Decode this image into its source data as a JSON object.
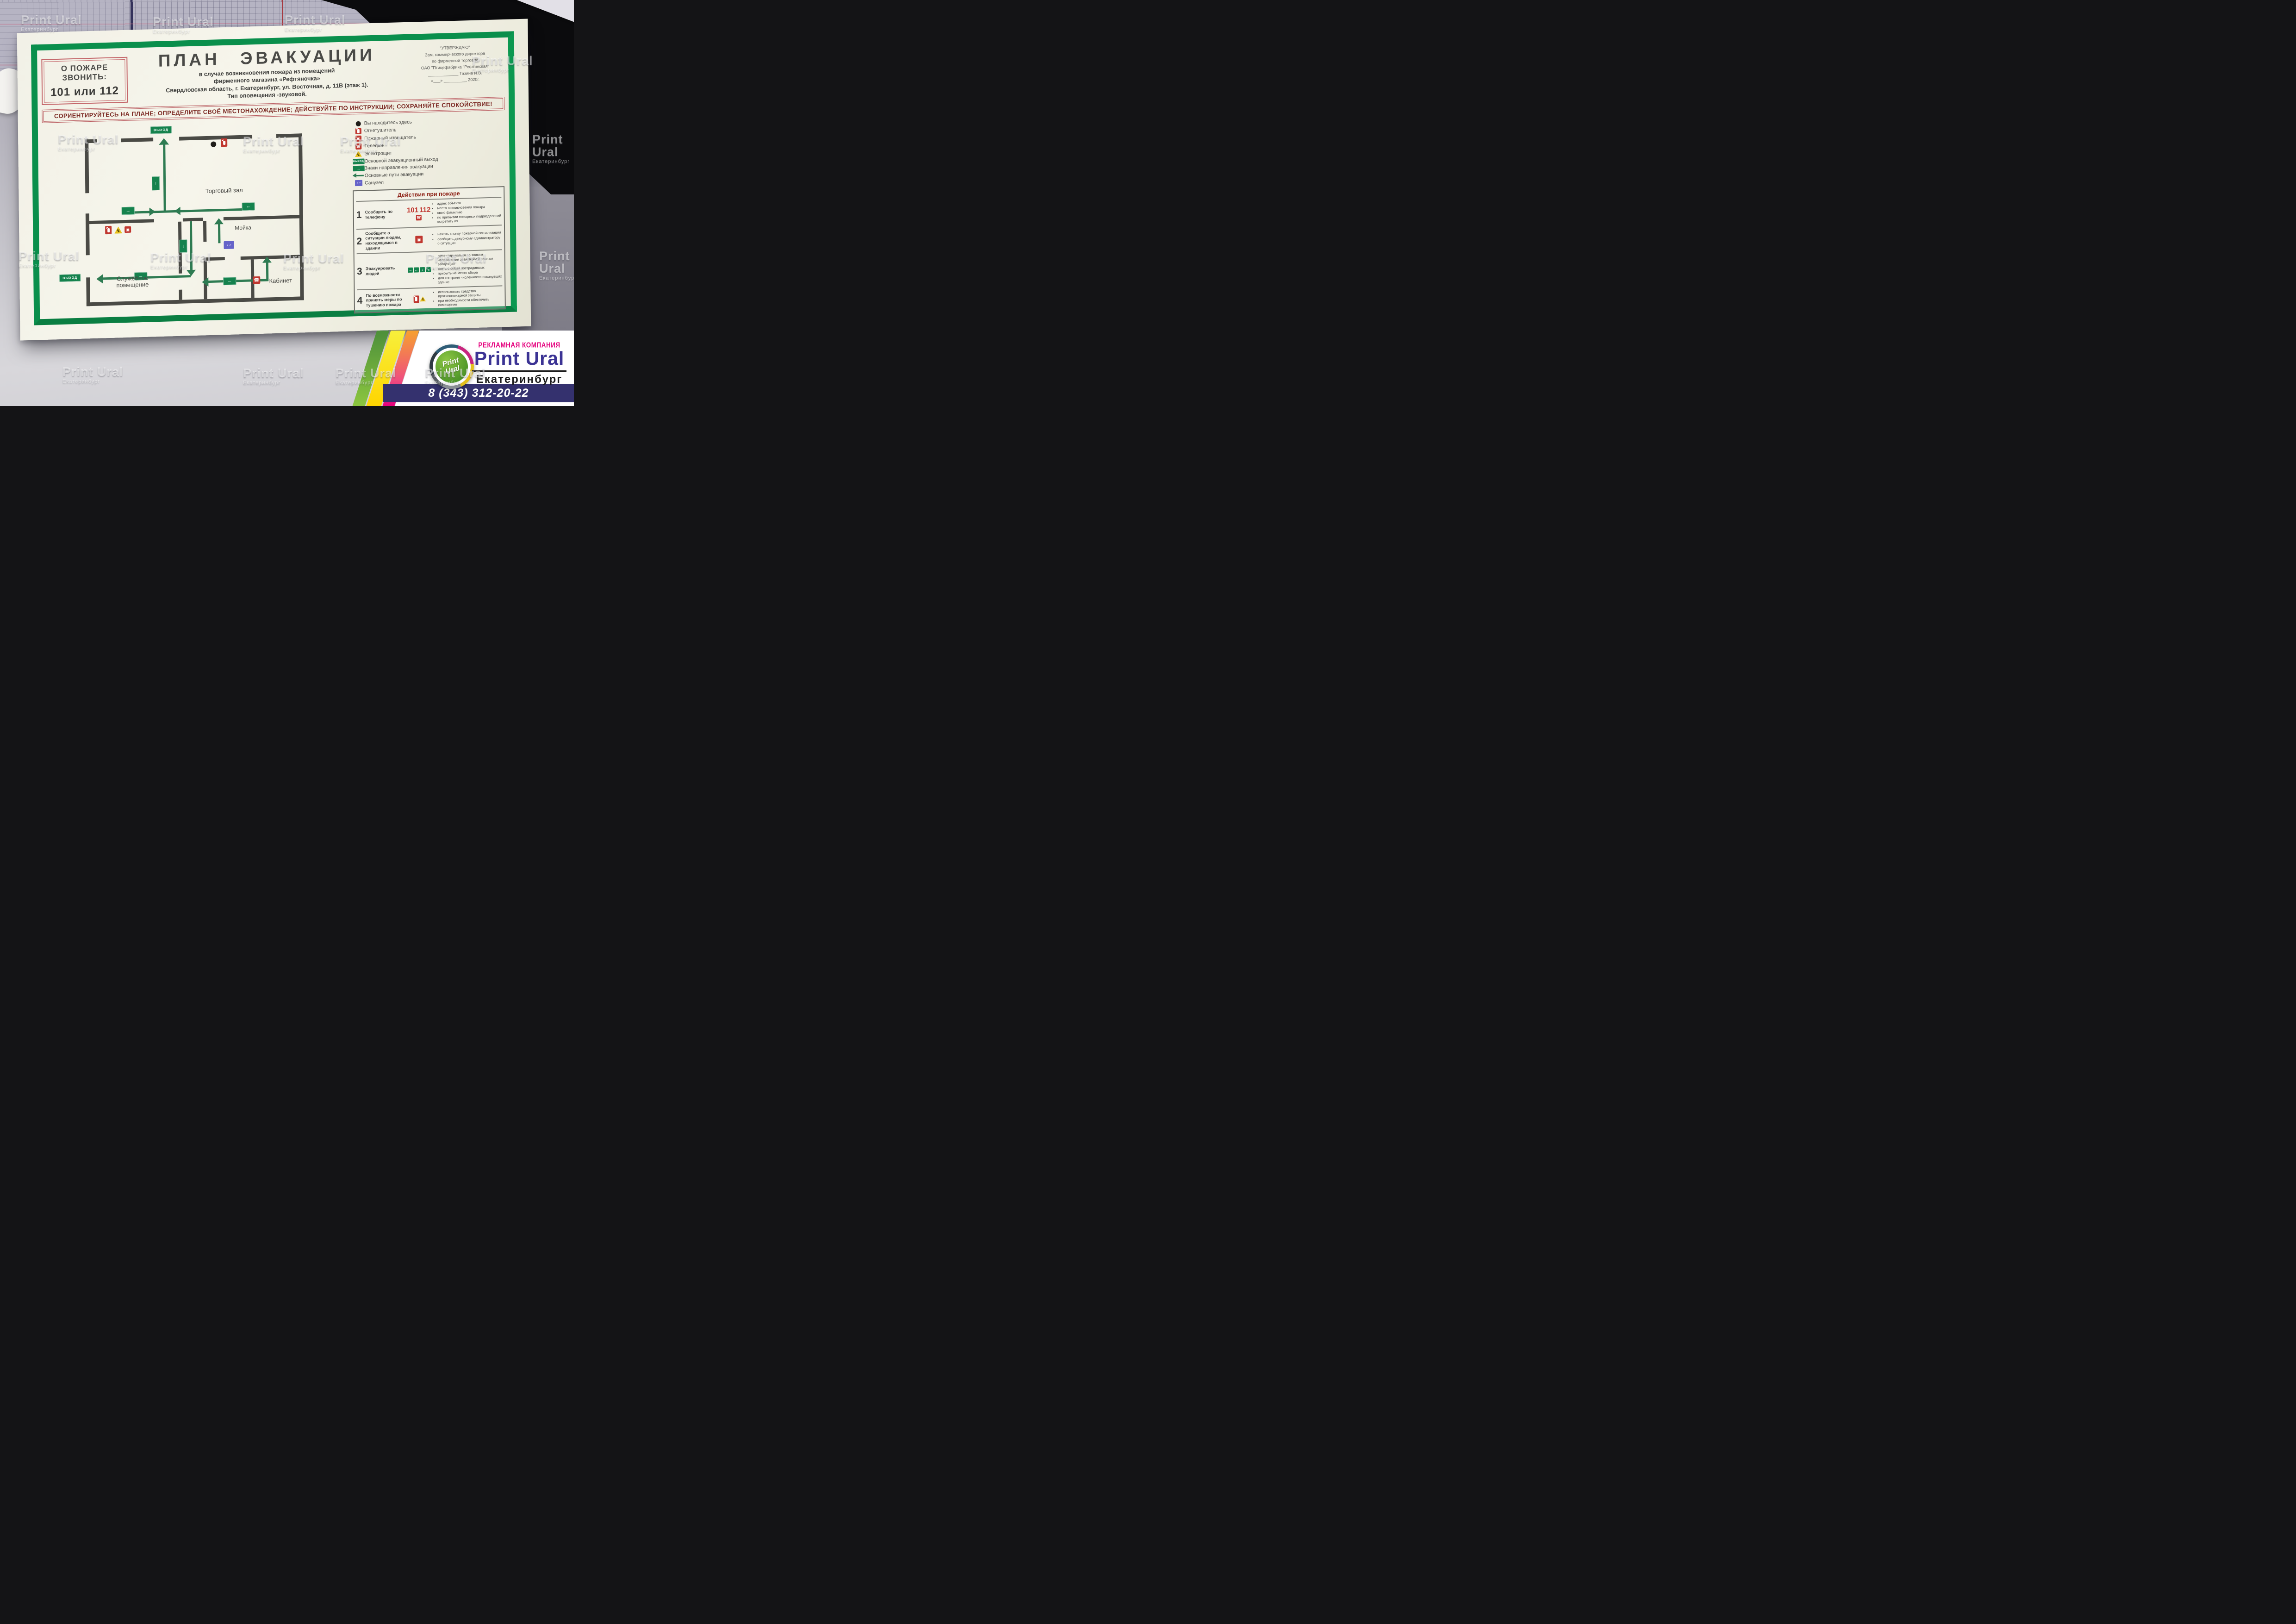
{
  "watermark": {
    "name": "Print Ural",
    "city": "Екатеринбург"
  },
  "scene": {
    "ruler_marks": [
      "210",
      "40"
    ]
  },
  "board": {
    "emergency_call_box": {
      "line1": "О ПОЖАРЕ",
      "line2": "ЗВОНИТЬ:",
      "line3": "101 или 112"
    },
    "title": "ПЛАН ЭВАКУАЦИИ",
    "subtitle": [
      "в случае возникновения пожара из помещений",
      "фирменного магазина «Рефтяночка»",
      "Свердловская область,  г. Екатеринбург, ул. Восточная, д. 11В (этаж 1).",
      "Тип оповещения -звуковой."
    ],
    "approval": {
      "line1": "\"УТВЕРЖДАЮ\"",
      "line2": "Зам. коммерческого директора",
      "line3": "по фирменной торговле",
      "line4": "ОАО \"Птицефабрика \"Рефтинская\"",
      "signature": "_____________  Тазина И.В.",
      "date": "«___» __________ 2020г."
    },
    "banner": "СОРИЕНТИРУЙТЕСЬ НА ПЛАНЕ;  ОПРЕДЕЛИТЕ СВОЁ МЕСТОНАХОЖДЕНИЕ;  ДЕЙСТВУЙТЕ ПО ИНСТРУКЦИИ;  СОХРАНЯЙТЕ СПОКОЙСТВИЕ!",
    "plan": {
      "exit_label": "ВЫХОД",
      "rooms": {
        "hall": "Торговый зал",
        "wash": "Мойка",
        "service_line1": "Служебное",
        "service_line2": "помещение",
        "office": "Кабинет"
      }
    },
    "legend": {
      "items": [
        {
          "icon": "you-are-here-dot",
          "label": "Вы находитесь здесь"
        },
        {
          "icon": "fire-extinguisher",
          "label": "Огнетушитель"
        },
        {
          "icon": "fire-alarm-button",
          "label": "Пожарный извещатель"
        },
        {
          "icon": "phone",
          "label": "Телефон"
        },
        {
          "icon": "electrical-panel",
          "label": "Электрощит"
        },
        {
          "icon": "exit-sign",
          "label": "Основной эвакуационный выход"
        },
        {
          "icon": "direction-sign",
          "label": "Знаки направления эвакуации"
        },
        {
          "icon": "evacuation-path-arrow",
          "label": "Основные пути эвакуации"
        },
        {
          "icon": "wc-sign",
          "label": "Санузел"
        }
      ]
    },
    "actions": {
      "title": "Действия при пожаре",
      "rows": [
        {
          "num": "1",
          "text": "Сообщить по телефону",
          "phone_numbers": [
            "101",
            "112"
          ],
          "bullets": [
            "адрес объекта",
            "место возникновения пожара",
            "свою фамилию",
            "по прибытии пожарных подразделений встретить их"
          ]
        },
        {
          "num": "2",
          "text": "Сообщите о ситуации людям, находящимся в здании",
          "bullets": [
            "нажать кнопку пожарной сигнализации",
            "сообщить дежурному администратору о ситуации"
          ]
        },
        {
          "num": "3",
          "text": "Эвакуировать людей",
          "bullets": [
            "ориентироваться по знакам направления эвакуации и планам эвакуации",
            "взять с собой пострадавших",
            "прибыть на место сбора",
            "для контроля численности покинувших здание"
          ]
        },
        {
          "num": "4",
          "text": "По возможности принять меры по тушению пожара",
          "bullets": [
            "использовать средства противопожарной защиты",
            "при необходимости обесточить помещение"
          ]
        }
      ]
    }
  },
  "brand": {
    "tagline": "РЕКЛАМНАЯ КОМПАНИЯ",
    "name": "Print Ural",
    "city": "Екатеринбург",
    "phone": "8 (343) 312-20-22",
    "logo_line1": "Print",
    "logo_line2": "Ural"
  },
  "colors": {
    "frame_green": "#0a8f4c",
    "path_green": "#2e7b52",
    "sign_green": "#15824d",
    "accent_red": "#c0372f",
    "banner_red": "#7c2a24",
    "action_title_red": "#8c1f14",
    "wc_blue": "#6663c9",
    "brand_magenta": "#e5007d",
    "brand_indigo": "#3b3394",
    "bar_navy": "#34316e"
  }
}
